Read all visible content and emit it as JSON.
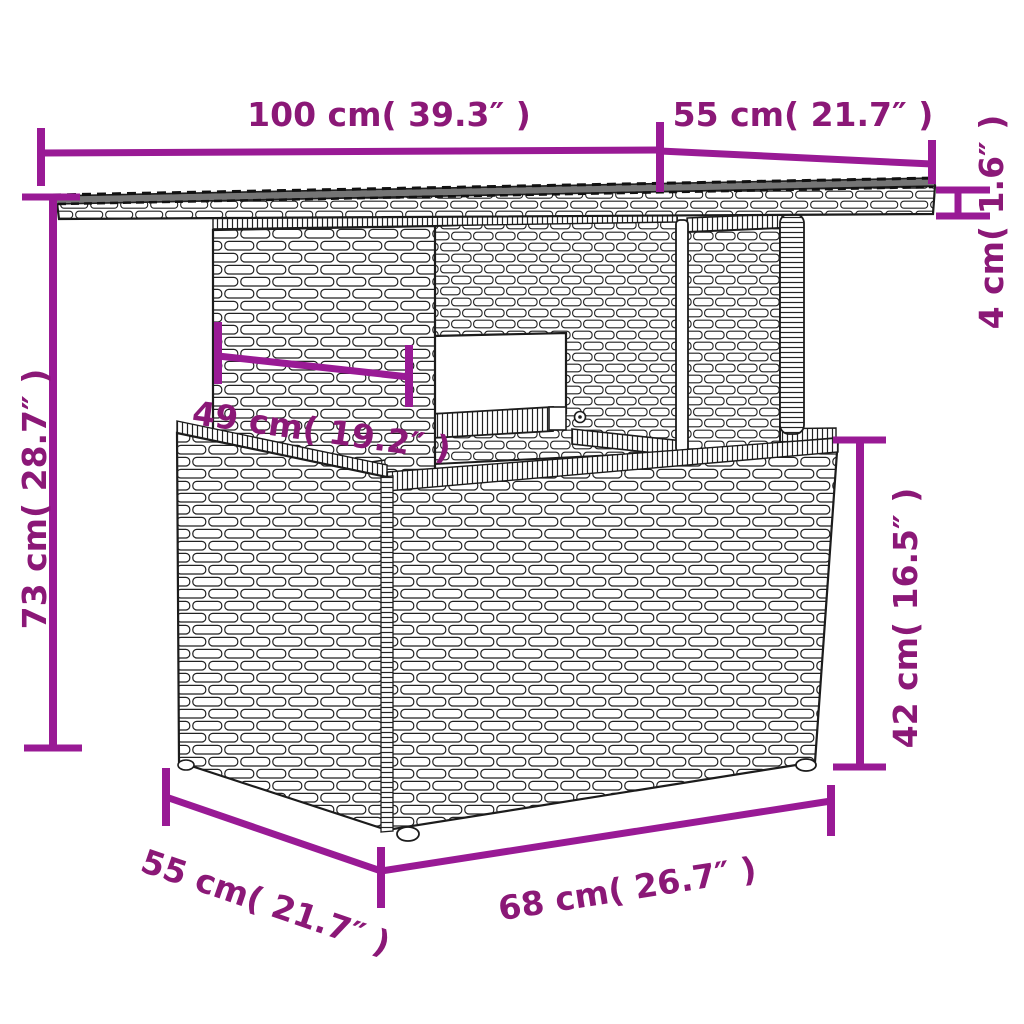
{
  "page": {
    "background_color": "#ffffff"
  },
  "illustration": {
    "subject": "poly rattan garden table line drawing — glass top, wide woven pedestal, storage box base",
    "outline_color": "#1c1c1c",
    "glass_top_color": "#757575"
  },
  "dimension_style": {
    "line_color": "#991A95",
    "text_color": "#8B1877"
  },
  "dimensions": {
    "tabletop_width": {
      "label": "100 cm( 39.3″ )"
    },
    "tabletop_depth": {
      "label": "55 cm( 21.7″ )"
    },
    "tabletop_thickness": {
      "label": "4 cm( 1.6″ )"
    },
    "overall_height": {
      "label": "73 cm( 28.7″ )"
    },
    "pedestal_width": {
      "label": "49 cm( 19.2″ )"
    },
    "base_height": {
      "label": "42 cm( 16.5″ )"
    },
    "base_depth": {
      "label": "55 cm( 21.7″ )"
    },
    "base_width": {
      "label": "68 cm( 26.7″ )"
    }
  }
}
